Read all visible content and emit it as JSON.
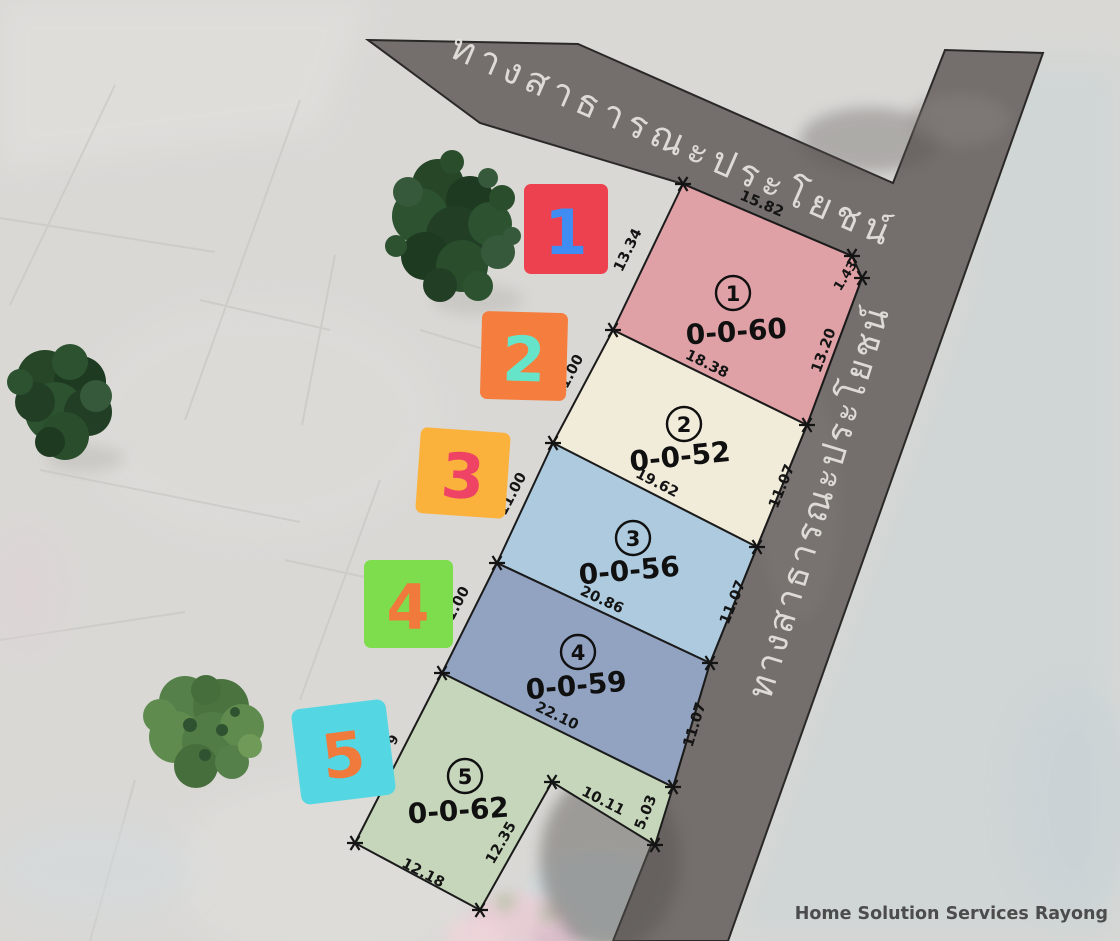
{
  "watermark": "Home Solution Services Rayong",
  "roads": {
    "top_label": "ทางสาธารณะประโยชน์",
    "right_label": "ทางสาธารณะประโยชน์",
    "color": "#746e6c"
  },
  "plots": [
    {
      "number": "1",
      "area": "0-0-60",
      "color": "#dfa1a6",
      "dims": {
        "top": "15.82",
        "left": "13.34",
        "notch": "1.43",
        "right": "13.20",
        "bottom": "18.38"
      }
    },
    {
      "number": "2",
      "area": "0-0-52",
      "color": "#f1ebd9",
      "dims": {
        "left": "11.00",
        "right": "11.07",
        "bottom": "19.62"
      }
    },
    {
      "number": "3",
      "area": "0-0-56",
      "color": "#adcade",
      "dims": {
        "left": "11.00",
        "right": "11.07",
        "bottom": "20.86"
      }
    },
    {
      "number": "4",
      "area": "0-0-59",
      "color": "#92a2c1",
      "dims": {
        "left": "11.00",
        "right": "11.07",
        "bottom": "22.10"
      }
    },
    {
      "number": "5",
      "area": "0-0-62",
      "color": "#c6d6bb",
      "dims": {
        "arm_bottom": "10.11",
        "arm_right": "5.03",
        "inner": "12.35",
        "bottom": "12.18",
        "left_partial": "9"
      }
    }
  ],
  "badges": [
    {
      "number": "1",
      "bg": "#ee4150",
      "fg": "#3f8df2"
    },
    {
      "number": "2",
      "bg": "#f57e3e",
      "fg": "#66e4c9"
    },
    {
      "number": "3",
      "bg": "#fbb23d",
      "fg": "#ef4365"
    },
    {
      "number": "4",
      "bg": "#7ddd4d",
      "fg": "#ef7a3b"
    },
    {
      "number": "5",
      "bg": "#54d7e2",
      "fg": "#f0793c"
    }
  ]
}
